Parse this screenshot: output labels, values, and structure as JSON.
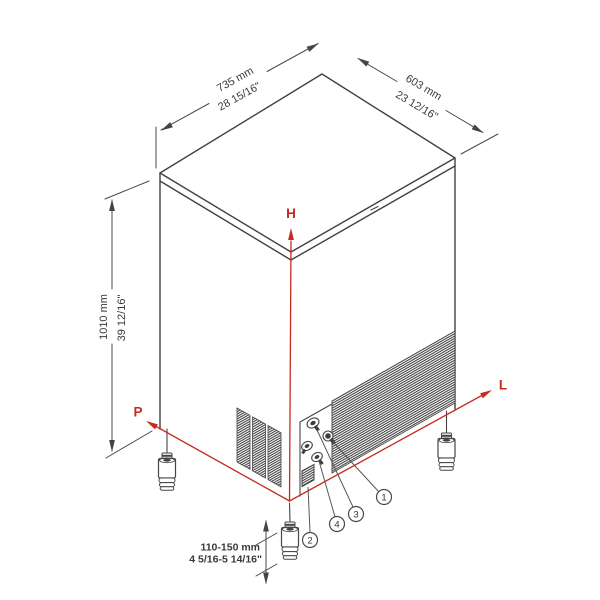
{
  "dimensions": {
    "width": {
      "mm": "735 mm",
      "inch": "28 15/16\""
    },
    "depth": {
      "mm": "603 mm",
      "inch": "23 12/16\""
    },
    "height": {
      "mm": "1010 mm",
      "inch": "39 12/16\""
    },
    "feet_range": {
      "mm": "110-150 mm",
      "inch": "4 5/16-5 14/16\""
    }
  },
  "axes": {
    "height": "H",
    "length": "L",
    "depth": "P"
  },
  "callouts": {
    "1": "1",
    "2": "2",
    "3": "3",
    "4": "4"
  },
  "colors": {
    "axis_red": "#c62b20",
    "line_dark": "#414141",
    "dim_text": "#3a3a3a"
  }
}
